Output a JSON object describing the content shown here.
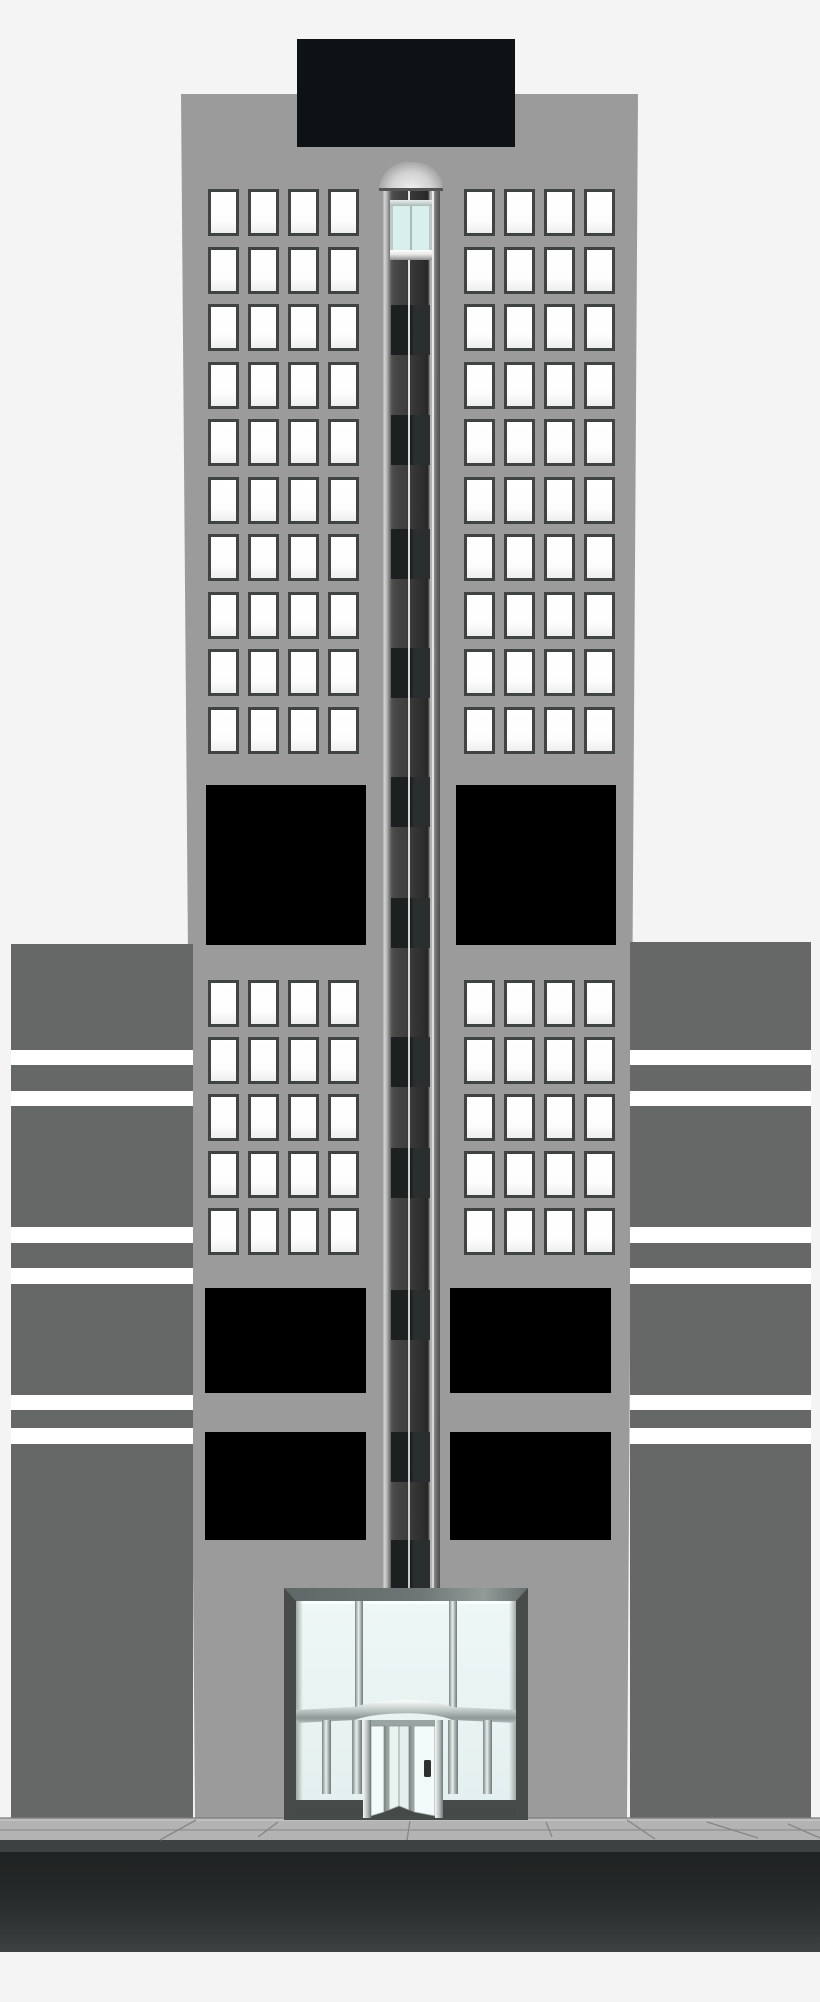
{
  "title": "skyscraper-illustration",
  "palette": {
    "bg": "#f4f4f4",
    "facade": "#9b9b9b",
    "slab": "#666868",
    "stripe": "#ffffff",
    "win_frame": "#3f4443",
    "win_glass": "#fdfdfd",
    "panel": "#000000",
    "sign": "#0e1214",
    "sidewalk": "#b3b3b3",
    "curb": "#3e4141",
    "road_top": "#202323",
    "road_bottom": "#3e4141",
    "car_glass": "#d9efed"
  },
  "building": {
    "top": 94,
    "bottom": 1818,
    "top_left": 181,
    "top_right": 638,
    "bottom_left": 195,
    "bottom_right": 627
  },
  "rooftop_sign": {
    "x": 297,
    "y": 39,
    "w": 218,
    "h": 108
  },
  "windows": {
    "width": 31,
    "height": 47,
    "left_cols": [
      208,
      248,
      288,
      328
    ],
    "right_cols": [
      464,
      504,
      544,
      584
    ],
    "upper_rows": [
      189,
      247,
      304,
      362,
      419,
      477,
      534,
      592,
      649,
      707
    ],
    "lower_rows": [
      980,
      1037,
      1094,
      1151,
      1208
    ]
  },
  "black_panels": [
    {
      "x": 206,
      "y": 785,
      "w": 160,
      "h": 160
    },
    {
      "x": 456,
      "y": 785,
      "w": 160,
      "h": 160
    },
    {
      "x": 205,
      "y": 1288,
      "w": 161,
      "h": 105
    },
    {
      "x": 450,
      "y": 1288,
      "w": 161,
      "h": 105
    },
    {
      "x": 205,
      "y": 1432,
      "w": 161,
      "h": 108
    },
    {
      "x": 450,
      "y": 1432,
      "w": 161,
      "h": 108
    }
  ],
  "elevator": {
    "shaft": {
      "x": 382,
      "top": 189,
      "w": 58,
      "bottom": 1592
    },
    "rails_offset": [
      25.5,
      49.5
    ],
    "doors": {
      "x_offset": 9,
      "w": 39,
      "h": 50,
      "ys": [
        305,
        415,
        529,
        648,
        777,
        898,
        1037,
        1148,
        1290,
        1432,
        1540
      ]
    },
    "dome": {
      "x": 379,
      "y": 162,
      "w": 64,
      "h": 28
    },
    "dome_base": {
      "x": 379,
      "y": 188,
      "w": 64,
      "h": 3
    },
    "car": {
      "x": 390,
      "y": 200,
      "w": 42,
      "h": 60
    }
  },
  "background_buildings": {
    "left": {
      "x": 11,
      "y": 944,
      "w": 182,
      "h": 874
    },
    "right": {
      "x": 630,
      "y": 942,
      "w": 181,
      "h": 876
    },
    "stripes": [
      {
        "y": 1050,
        "h": 15
      },
      {
        "y": 1091,
        "h": 15
      },
      {
        "y": 1227,
        "h": 16
      },
      {
        "y": 1268,
        "h": 16
      },
      {
        "y": 1395,
        "h": 15
      },
      {
        "y": 1428,
        "h": 16
      }
    ]
  },
  "street": {
    "sidewalk": {
      "y": 1818,
      "h": 22
    },
    "curb": {
      "y": 1840,
      "h": 12
    },
    "road": {
      "y": 1852,
      "h": 100
    },
    "lines": [
      {
        "x1": 0,
        "y1": 1818,
        "x2": 820,
        "y2": 1818,
        "c": "#7f7f7f"
      },
      {
        "x1": 0,
        "y1": 1820,
        "x2": 820,
        "y2": 1820,
        "c": "#c8c8c8"
      },
      {
        "x1": 0,
        "y1": 1830,
        "x2": 820,
        "y2": 1830,
        "c": "#8f8f8f"
      }
    ],
    "seams": [
      {
        "x1": 196,
        "y1": 1820,
        "x2": 160,
        "y2": 1840
      },
      {
        "x1": 278,
        "y1": 1822,
        "x2": 258,
        "y2": 1837
      },
      {
        "x1": 410,
        "y1": 1821,
        "x2": 407,
        "y2": 1840
      },
      {
        "x1": 546,
        "y1": 1822,
        "x2": 552,
        "y2": 1837
      },
      {
        "x1": 627,
        "y1": 1820,
        "x2": 655,
        "y2": 1839
      },
      {
        "x1": 707,
        "y1": 1822,
        "x2": 758,
        "y2": 1838
      },
      {
        "x1": 788,
        "y1": 1824,
        "x2": 820,
        "y2": 1838
      }
    ]
  },
  "entrance": {
    "x": 284,
    "y": 1586,
    "w": 244,
    "h": 236
  }
}
